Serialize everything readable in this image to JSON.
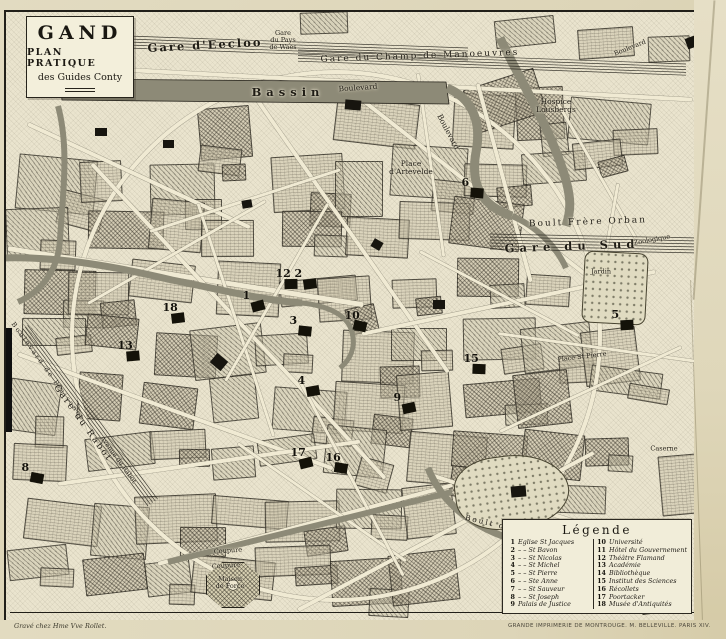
{
  "title_box": {
    "title": "GAND",
    "subtitle": "PLAN PRATIQUE",
    "edition": "des Guides Conty"
  },
  "colors": {
    "paper": "#ddd5b8",
    "map_background": "#eae4ce",
    "ink": "#211f19",
    "water": "#8d8a77"
  },
  "legend": {
    "title": "Légende",
    "left": [
      {
        "n": "1",
        "label": "Eglise St Jacques"
      },
      {
        "n": "2",
        "label": "– –  St Bavon"
      },
      {
        "n": "3",
        "label": "– –  St Nicolas"
      },
      {
        "n": "4",
        "label": "– –  St Michel"
      },
      {
        "n": "5",
        "label": "– –  St Pierre"
      },
      {
        "n": "6",
        "label": "– –  Ste Anne"
      },
      {
        "n": "7",
        "label": "– –  St Sauveur"
      },
      {
        "n": "8",
        "label": "– –  St Joseph"
      },
      {
        "n": "9",
        "label": "Palais de Justice"
      }
    ],
    "right": [
      {
        "n": "10",
        "label": "Université"
      },
      {
        "n": "11",
        "label": "Hôtel du Gouvernement"
      },
      {
        "n": "12",
        "label": "Théâtre Flamand"
      },
      {
        "n": "13",
        "label": "Académie"
      },
      {
        "n": "14",
        "label": "Bibliothèque"
      },
      {
        "n": "15",
        "label": "Institut des Sciences"
      },
      {
        "n": "16",
        "label": "Récollets"
      },
      {
        "n": "17",
        "label": "Poortacker"
      },
      {
        "n": "18",
        "label": "Musée d'Antiquités"
      }
    ]
  },
  "map": {
    "labels": [
      {
        "t": "Gare d'Eecloo",
        "x": 205,
        "y": 45,
        "r": -3,
        "cls": "l-md sp"
      },
      {
        "t": "Gare\ndu Pays\nde Waes",
        "x": 283,
        "y": 40,
        "r": 0,
        "cls": "l-xxs"
      },
      {
        "t": "Gare du Champ de Manoeuvres",
        "x": 420,
        "y": 57,
        "r": -2,
        "cls": "l-sm sp"
      },
      {
        "t": "Grand",
        "x": 102,
        "y": 88,
        "r": 0,
        "cls": "l-md sp2"
      },
      {
        "t": "Bassin",
        "x": 288,
        "y": 92,
        "r": 0,
        "cls": "l-md sp2"
      },
      {
        "t": "Boulevard",
        "x": 358,
        "y": 88,
        "r": -4,
        "cls": "l-xs"
      },
      {
        "t": "Boulevard",
        "x": 448,
        "y": 132,
        "r": 62,
        "cls": "l-xs"
      },
      {
        "t": "Hospice\nLousbergs",
        "x": 556,
        "y": 106,
        "r": 0,
        "cls": "l-xs"
      },
      {
        "t": "Boulevard",
        "x": 630,
        "y": 48,
        "r": -22,
        "cls": "l-xxs"
      },
      {
        "t": "Boult Frère Orban",
        "x": 588,
        "y": 223,
        "r": -2,
        "cls": "l-sm sp"
      },
      {
        "t": "Gare du Sud",
        "x": 572,
        "y": 246,
        "r": -2,
        "cls": "l-md sp2"
      },
      {
        "t": "Jardin",
        "x": 601,
        "y": 272,
        "r": 0,
        "cls": "l-xxs"
      },
      {
        "t": "Zoologique",
        "x": 652,
        "y": 240,
        "r": -10,
        "cls": "l-xxs"
      },
      {
        "t": "Place\nd'Artevelde",
        "x": 411,
        "y": 168,
        "r": 0,
        "cls": "l-xs"
      },
      {
        "t": "Place St Pierre",
        "x": 582,
        "y": 357,
        "r": -7,
        "cls": "l-xxs"
      },
      {
        "t": "Boulevard de Plaisance",
        "x": 48,
        "y": 372,
        "r": 54,
        "cls": "l-xxs sp"
      },
      {
        "t": "Gare du Rabot",
        "x": 82,
        "y": 424,
        "r": 54,
        "cls": "l-sm sp"
      },
      {
        "t": "Avenue du Rabot",
        "x": 118,
        "y": 460,
        "r": 54,
        "cls": "l-xxs"
      },
      {
        "t": "Coupure",
        "x": 228,
        "y": 551,
        "r": -4,
        "cls": "l-xxs"
      },
      {
        "t": "Coupure",
        "x": 226,
        "y": 566,
        "r": -4,
        "cls": "l-xxs"
      },
      {
        "t": "Maison\nde Force",
        "x": 230,
        "y": 583,
        "r": 0,
        "cls": "l-xxs"
      },
      {
        "t": "Boult des Hospices",
        "x": 518,
        "y": 530,
        "r": 13,
        "cls": "l-xs sp"
      },
      {
        "t": "Caserne",
        "x": 664,
        "y": 449,
        "r": 0,
        "cls": "l-xxs"
      }
    ],
    "markers": [
      {
        "n": "1",
        "x": 258,
        "y": 306
      },
      {
        "n": "2",
        "x": 310,
        "y": 284
      },
      {
        "n": "12",
        "x": 291,
        "y": 284
      },
      {
        "n": "3",
        "x": 305,
        "y": 331
      },
      {
        "n": "10",
        "x": 360,
        "y": 326
      },
      {
        "n": "4",
        "x": 313,
        "y": 391
      },
      {
        "n": "5",
        "x": 627,
        "y": 325
      },
      {
        "n": "6",
        "x": 477,
        "y": 193
      },
      {
        "n": "8",
        "x": 37,
        "y": 478
      },
      {
        "n": "9",
        "x": 409,
        "y": 408
      },
      {
        "n": "13",
        "x": 133,
        "y": 356
      },
      {
        "n": "15",
        "x": 479,
        "y": 369
      },
      {
        "n": "16",
        "x": 341,
        "y": 468
      },
      {
        "n": "17",
        "x": 306,
        "y": 463
      },
      {
        "n": "18",
        "x": 178,
        "y": 318
      }
    ]
  },
  "footer": {
    "left": "Gravé chez Hme Vve Rollet.",
    "right": "GRANDE IMPRIMERIE DE MONTROUGE. M. BELLEVILLE. PARIS XIV."
  }
}
